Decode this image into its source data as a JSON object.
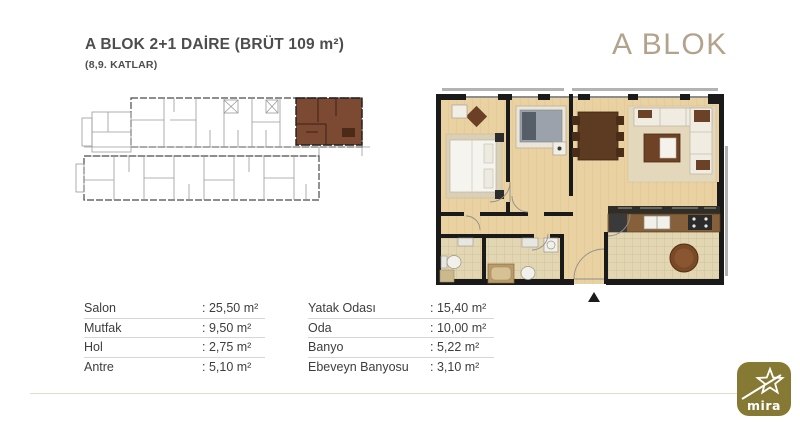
{
  "page": {
    "title": "A BLOK 2+1 DAİRE (BRÜT 109 m²)",
    "subtitle": "(8,9. KATLAR)",
    "block_heading": "A BLOK"
  },
  "tables": {
    "left": [
      {
        "label": "Salon",
        "value": ": 25,50 m²"
      },
      {
        "label": "Mutfak",
        "value": ": 9,50 m²"
      },
      {
        "label": "Hol",
        "value": ": 2,75 m²"
      },
      {
        "label": "Antre",
        "value": ": 5,10 m²"
      }
    ],
    "right": [
      {
        "label": "Yatak Odası",
        "value": ": 15,40 m²"
      },
      {
        "label": "Oda",
        "value": ": 10,00 m²"
      },
      {
        "label": "Banyo",
        "value": ": 5,22 m²"
      },
      {
        "label": "Ebeveyn Banyosu",
        "value": ": 3,10 m²"
      }
    ]
  },
  "logo": {
    "text": "mira"
  },
  "colors": {
    "block_heading": "#b2a48c",
    "highlight_unit_brown": "#7c4a33",
    "logo_gold": "#867934",
    "wood_floor": "#e9d1a1",
    "wall_black": "#1a1a1a"
  }
}
